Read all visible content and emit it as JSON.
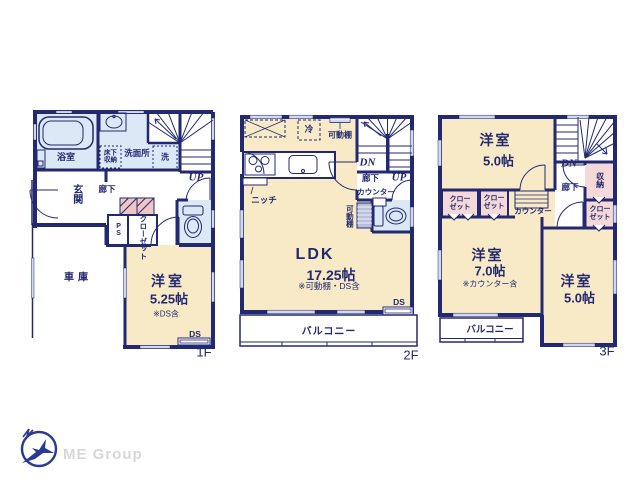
{
  "branding": {
    "company": "ME Group"
  },
  "colors": {
    "wall": "#232970",
    "text": "#232970",
    "room_cream": "#f8eac6",
    "room_blue": "#dbe8f5",
    "room_pink": "#f5d9d8",
    "hatch_pink": "#f0c6c5",
    "shelf_gray": "#b9c0dc",
    "window_gray": "#d2d8ee",
    "logo_navy": "#2b3990",
    "logo_text_gray": "#d7d7d7"
  },
  "floors": {
    "f1": {
      "floor_label": "1F",
      "bathroom": "浴室",
      "washroom": "洗面所",
      "underfloor_storage": "床下収納",
      "washer": "洗",
      "up": "UP",
      "entrance": "玄関",
      "hallway": "廊下",
      "ps": "PS",
      "closet": "クローゼット",
      "garage": "車庫",
      "bedroom": "洋室",
      "bedroom_size": "5.25帖",
      "bedroom_note": "※DS含",
      "ds": "DS"
    },
    "f2": {
      "floor_label": "2F",
      "fridge": "冷",
      "shelf_top": "可動棚",
      "niche": "ニッチ",
      "dn": "DN",
      "up": "UP",
      "hallway": "廊下",
      "counter": "カウンター",
      "shelf_side": "可動棚",
      "ldk": "LDK",
      "ldk_size": "17.25帖",
      "ldk_note": "※可動棚・DS含",
      "ds": "DS",
      "balcony": "バルコニー"
    },
    "f3": {
      "floor_label": "3F",
      "bedroom_a": "洋室",
      "bedroom_a_size": "5.0帖",
      "dn": "DN",
      "hallway": "廊下",
      "storage": "収納",
      "closet_a": "クローゼット",
      "closet_b": "クローゼット",
      "closet_c": "クローゼット",
      "counter": "カウンター",
      "bedroom_b": "洋室",
      "bedroom_b_size": "7.0帖",
      "bedroom_b_note": "※カウンター含",
      "bedroom_c": "洋室",
      "bedroom_c_size": "5.0帖",
      "balcony": "バルコニー"
    }
  }
}
